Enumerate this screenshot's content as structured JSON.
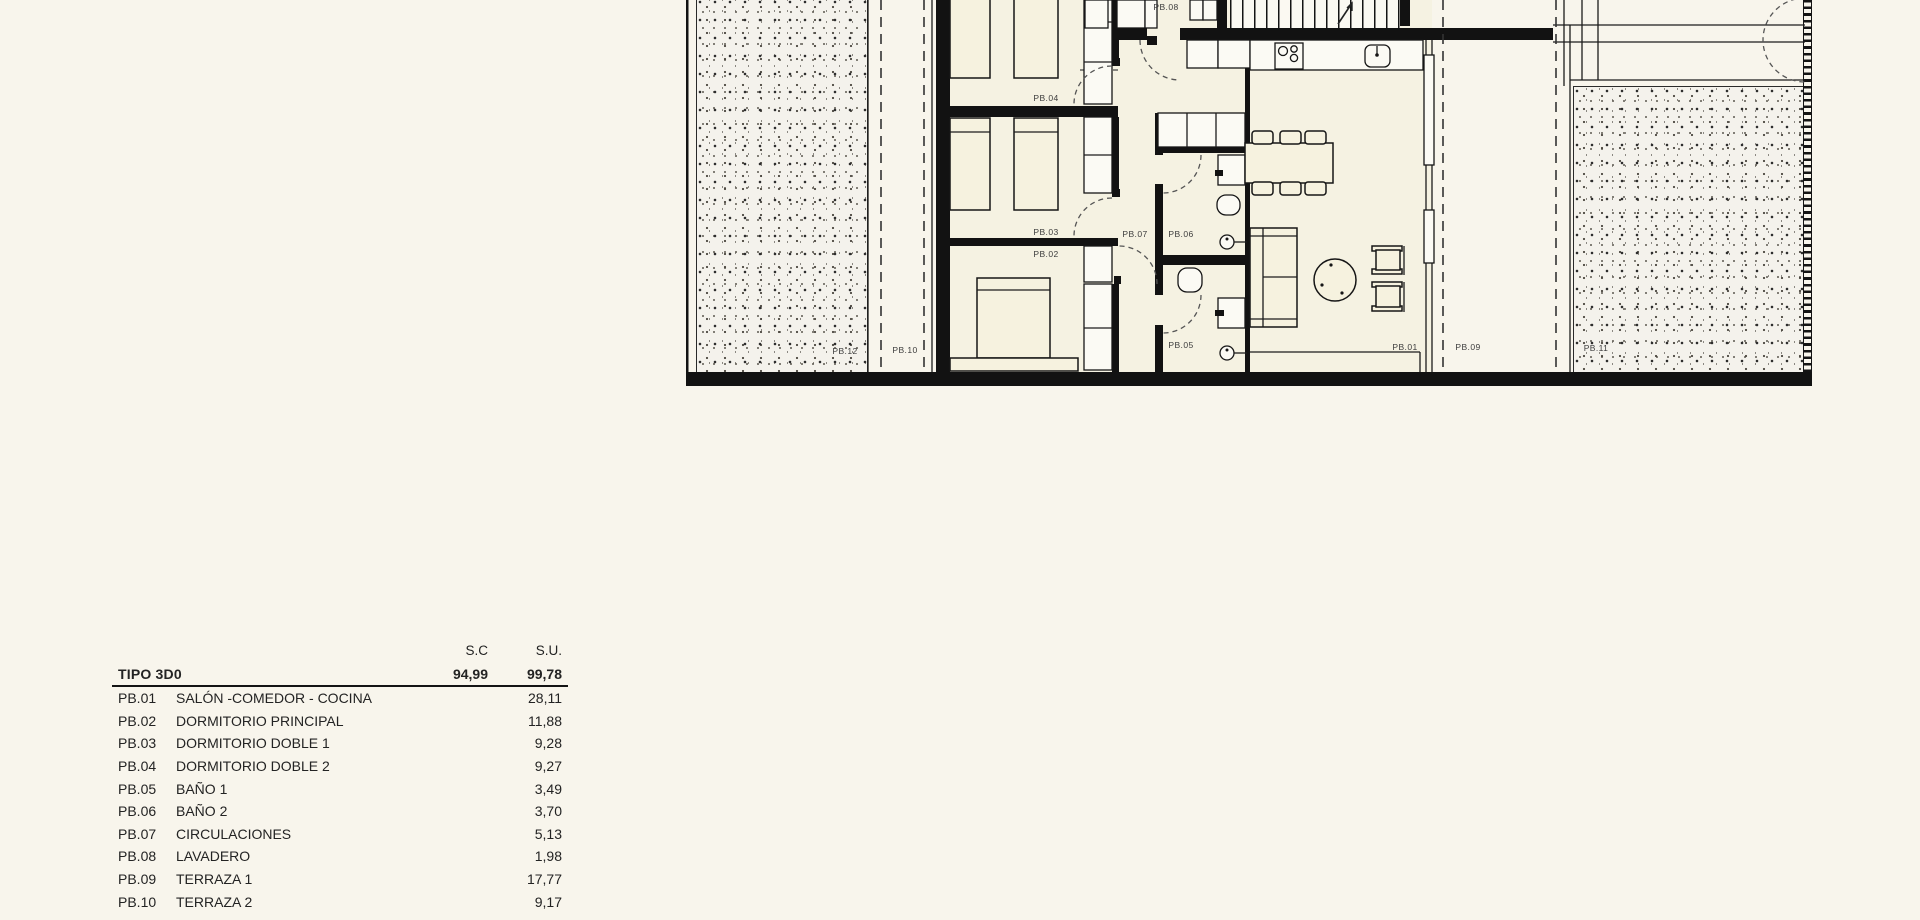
{
  "colors": {
    "paper": "#f8f5ec",
    "ink": "#141414"
  },
  "floor_plan": {
    "labels": {
      "pb01": "PB.01",
      "pb02": "PB.02",
      "pb03": "PB.03",
      "pb04": "PB.04",
      "pb05": "PB.05",
      "pb06": "PB.06",
      "pb07": "PB.07",
      "pb08": "PB.08",
      "pb09": "PB.09",
      "pb10": "PB.10",
      "pb11": "PB.11",
      "pb12": "PB.12"
    }
  },
  "area_table": {
    "columns": {
      "sc": "S.C",
      "su": "S.U."
    },
    "type_row": {
      "label": "TIPO 3D0",
      "sc": "94,99",
      "su": "99,78"
    },
    "rows": [
      {
        "code": "PB.01",
        "name": "SALÓN -COMEDOR - COCINA",
        "su": "28,11"
      },
      {
        "code": "PB.02",
        "name": "DORMITORIO PRINCIPAL",
        "su": "11,88"
      },
      {
        "code": "PB.03",
        "name": "DORMITORIO DOBLE 1",
        "su": "9,28"
      },
      {
        "code": "PB.04",
        "name": "DORMITORIO DOBLE 2",
        "su": "9,27"
      },
      {
        "code": "PB.05",
        "name": "BAÑO 1",
        "su": "3,49"
      },
      {
        "code": "PB.06",
        "name": "BAÑO 2",
        "su": "3,70"
      },
      {
        "code": "PB.07",
        "name": "CIRCULACIONES",
        "su": "5,13"
      },
      {
        "code": "PB.08",
        "name": "LAVADERO",
        "su": "1,98"
      },
      {
        "code": "PB.09",
        "name": "TERRAZA 1",
        "su": "17,77"
      },
      {
        "code": "PB.10",
        "name": "TERRAZA 2",
        "su": "9,17"
      }
    ]
  }
}
